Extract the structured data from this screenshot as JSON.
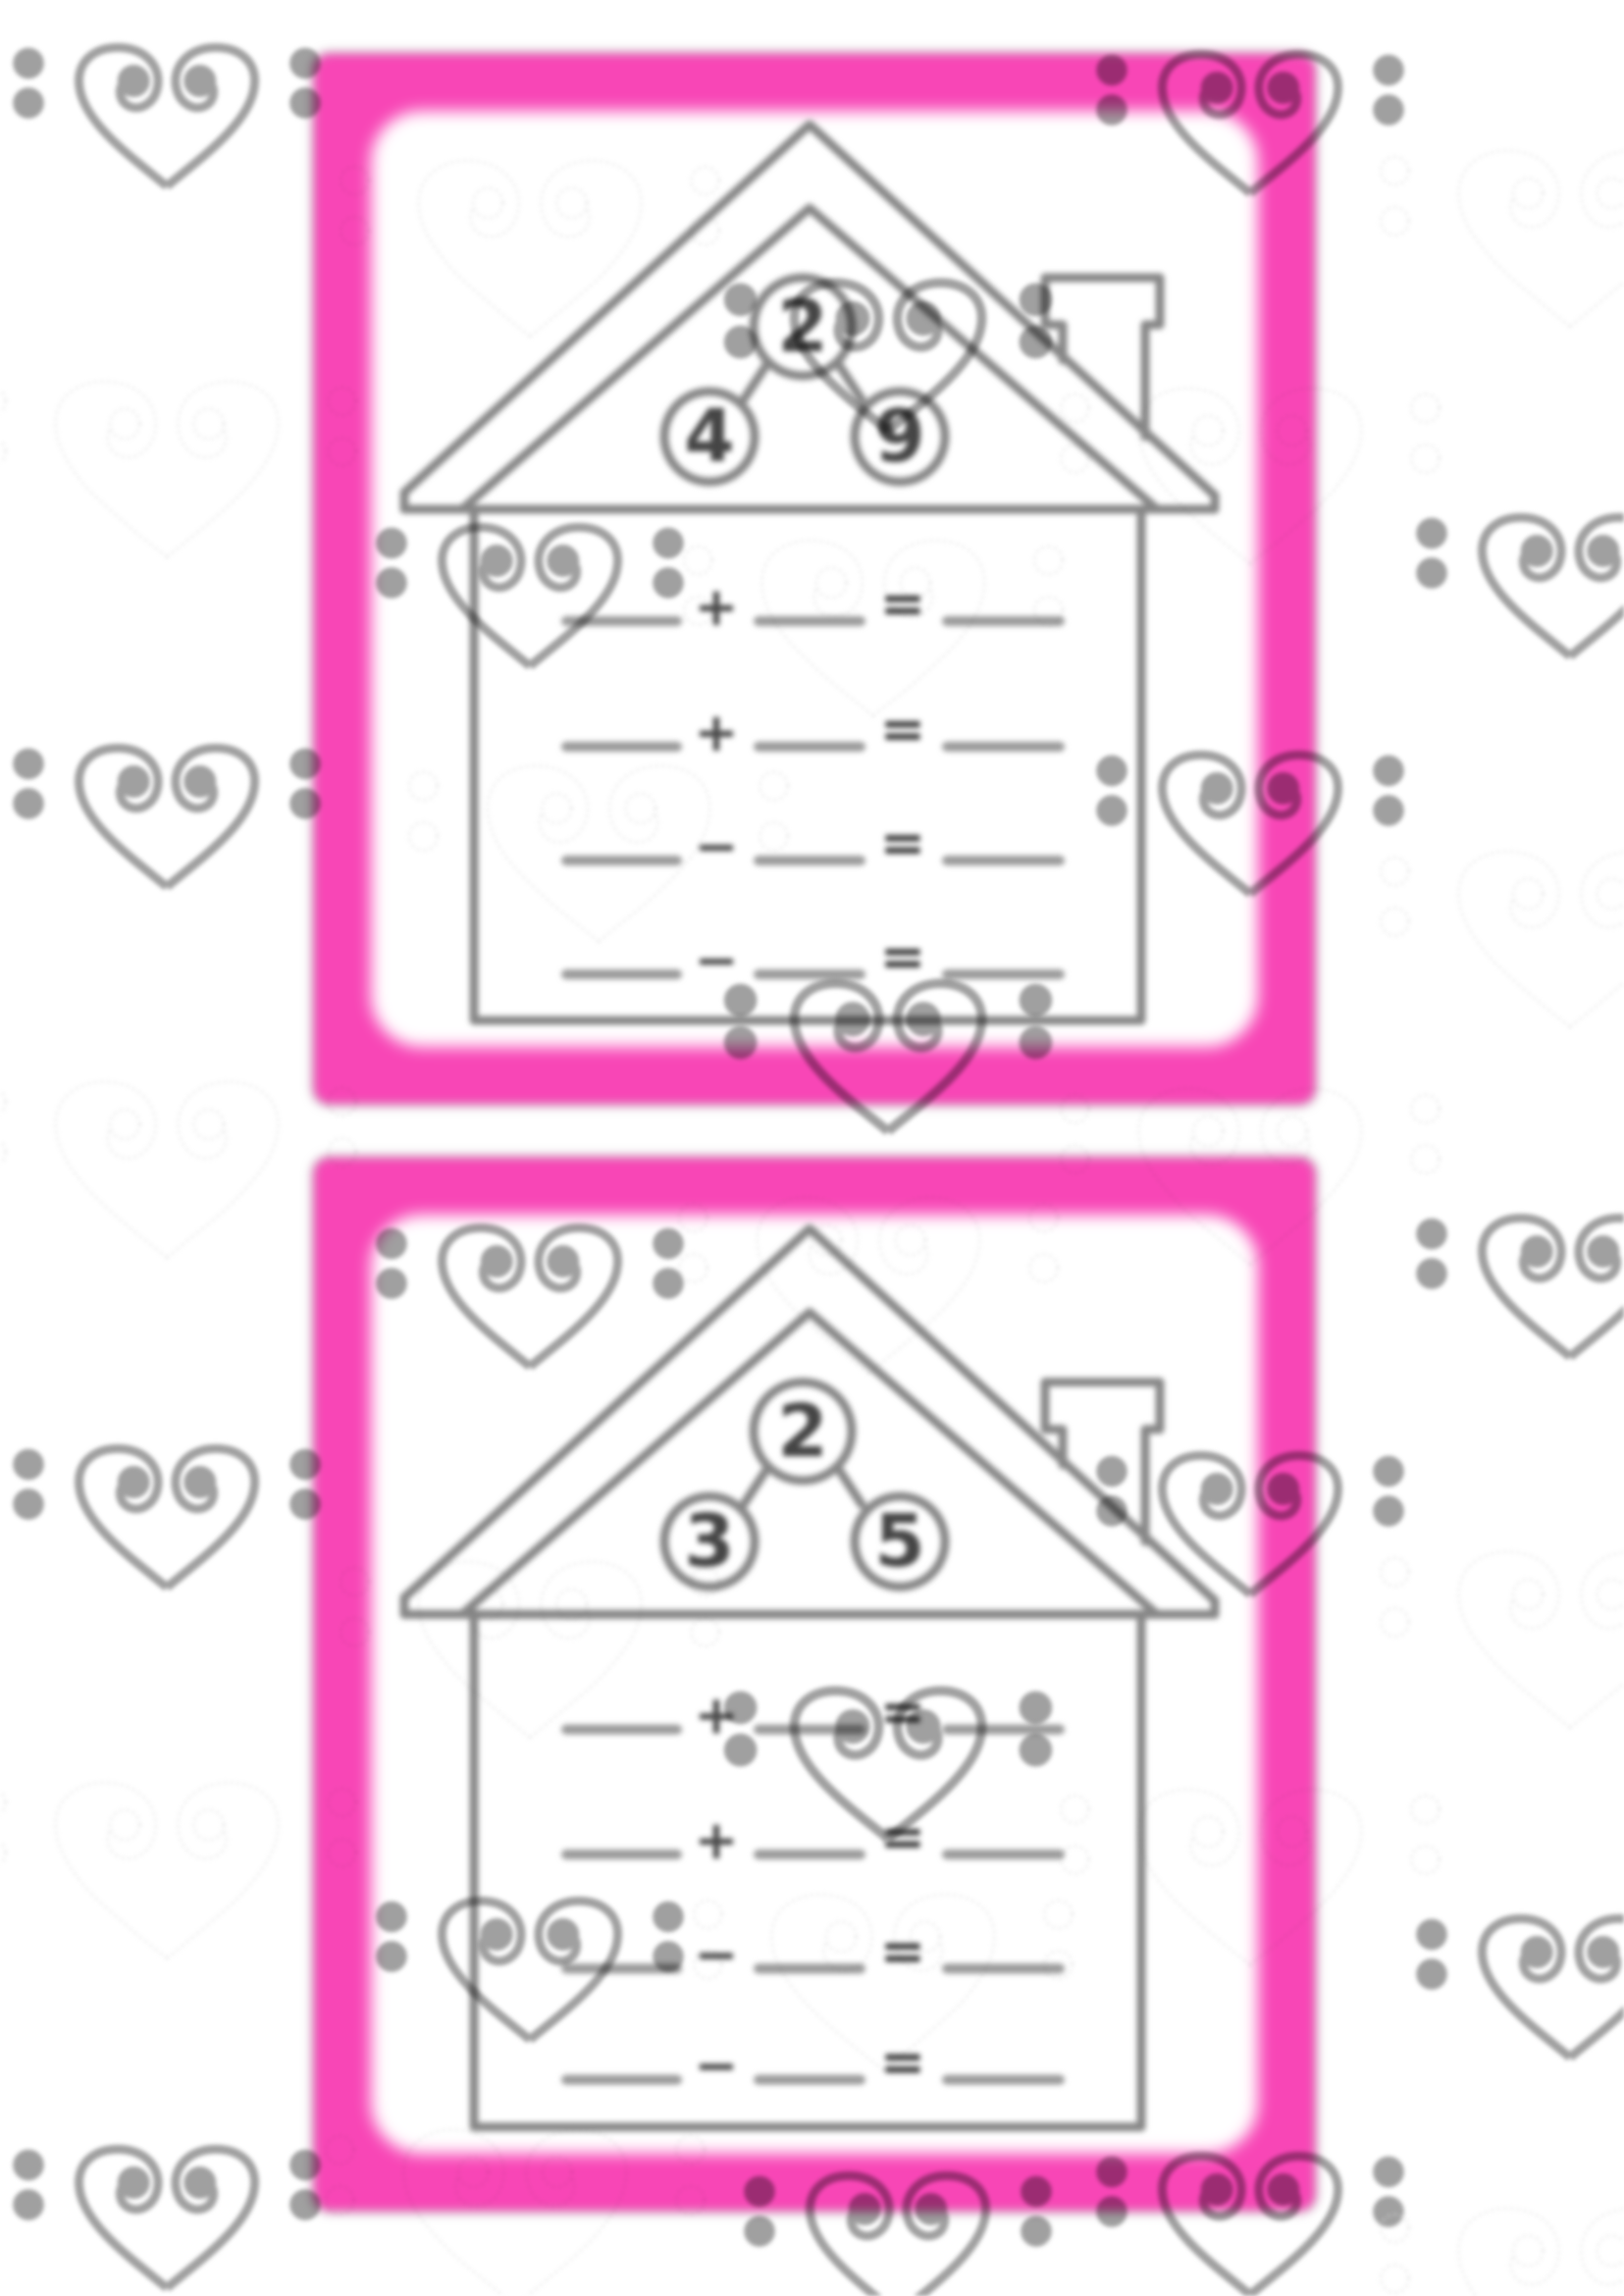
{
  "page": {
    "kind": "fact-family-house-worksheet",
    "background": "#ffffff"
  },
  "colors": {
    "card_border_pink": "#f846b6",
    "house_line_gray": "#878787",
    "blank_line_gray": "#9a9a9a",
    "digit_gray": "#454545",
    "watermark_gray": "#a0a0a0"
  },
  "symbols": {
    "equals": "="
  },
  "watermark": {
    "icon": "bass-clef-heart-icon"
  },
  "cards": [
    {
      "bond": {
        "top": "2",
        "left": "4",
        "right": "9"
      },
      "rows": [
        "+",
        "+",
        "−",
        "−"
      ]
    },
    {
      "bond": {
        "top": "2",
        "left": "3",
        "right": "5"
      },
      "rows": [
        "+",
        "+",
        "−",
        "−"
      ]
    }
  ]
}
